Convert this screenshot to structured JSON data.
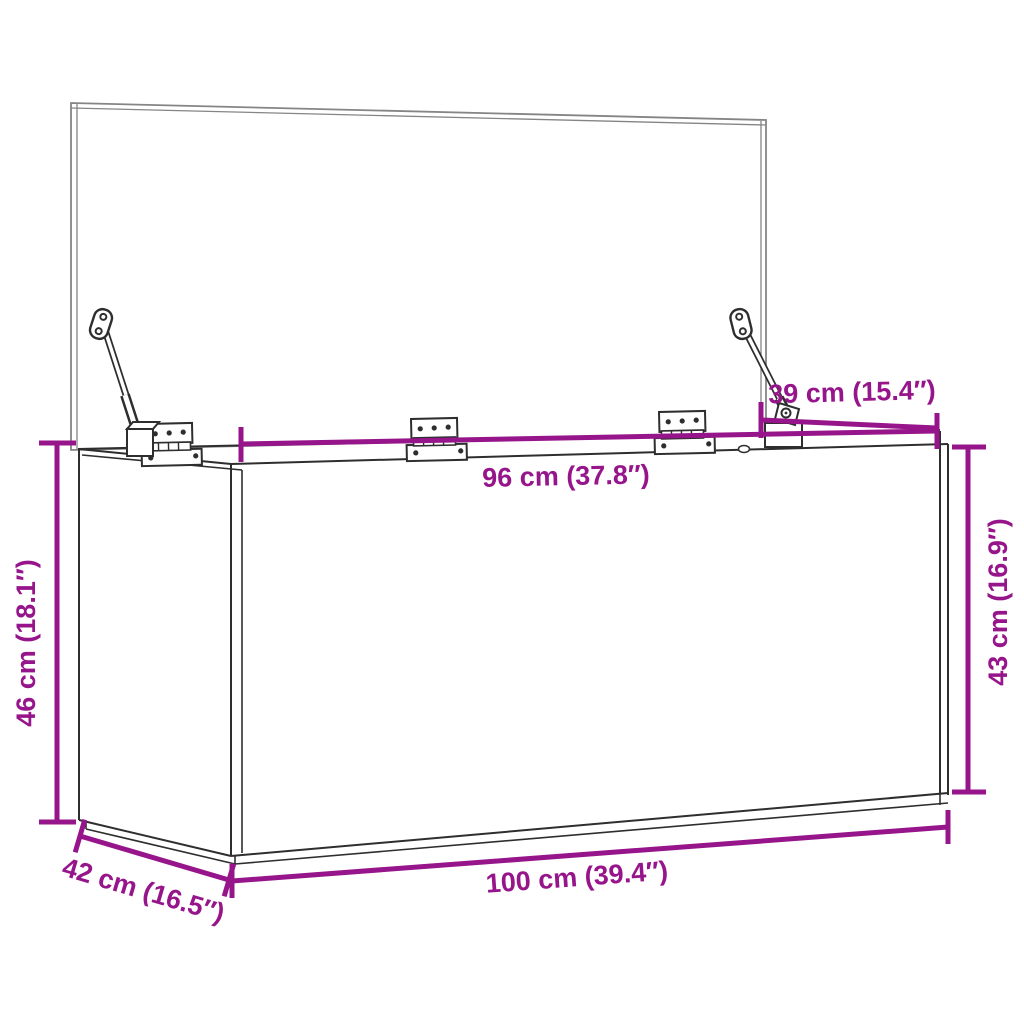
{
  "page": {
    "background": "#ffffff"
  },
  "diagram": {
    "description": "storage box with open lid, hinges and gas struts, dimension drawing",
    "dimension_color": "#97158a",
    "line_color": "#2e2e2e",
    "lid_line_color": "#858585",
    "labels": {
      "lid_depth": "39 cm (15.4″)",
      "top_width": "96 cm (37.8″)",
      "right_height": "43 cm (16.9″)",
      "left_height": "46 cm (18.1″)",
      "depth": "42 cm (16.5″)",
      "bottom_width": "100 cm (39.4″)"
    }
  }
}
